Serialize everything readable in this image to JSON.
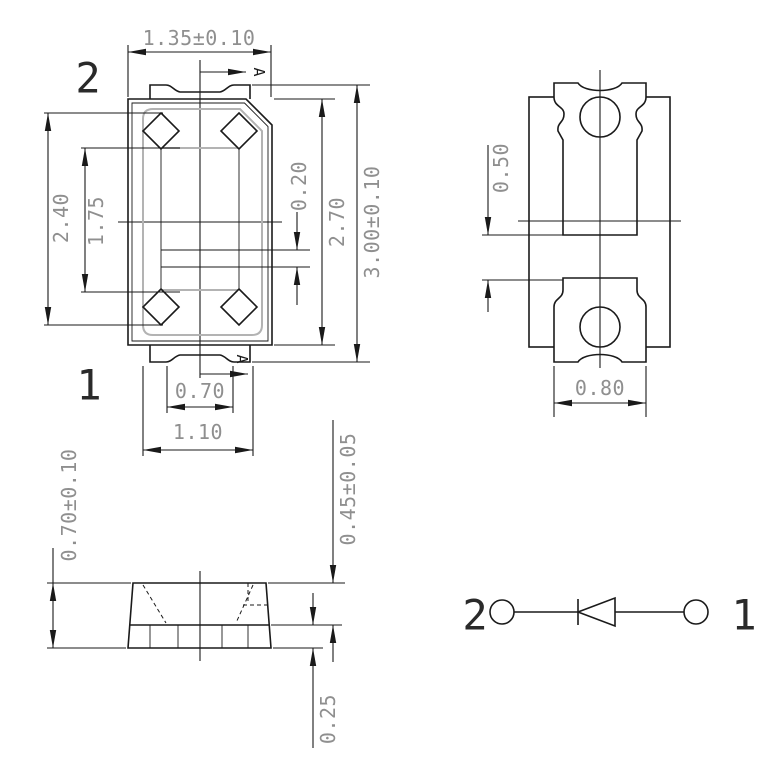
{
  "colors": {
    "line": "#1a1a1a",
    "auxiliary_gray": "#b3b3b3",
    "dimension_text": "#8f8f8f",
    "background": "#ffffff"
  },
  "top_view": {
    "pin2_label": "2",
    "pin1_label": "1",
    "dim_top_width": "1.35±0.10",
    "dim_left_outer": "2.40",
    "dim_left_inner": "1.75",
    "dim_center_gap": "0.20",
    "dim_right_body": "2.70",
    "dim_right_overall": "3.00±0.10",
    "dim_bottom_bump": "0.70",
    "dim_bottom_tab": "1.10",
    "section_label_top": "A",
    "section_label_bottom": "A"
  },
  "pad_layout": {
    "dim_gap": "0.50",
    "dim_width": "0.80"
  },
  "side_view": {
    "dim_total_height": "0.70±0.10",
    "dim_body_height": "0.45±0.05",
    "dim_lead_height": "0.25"
  },
  "schematic": {
    "pin2_label": "2",
    "pin1_label": "1"
  }
}
